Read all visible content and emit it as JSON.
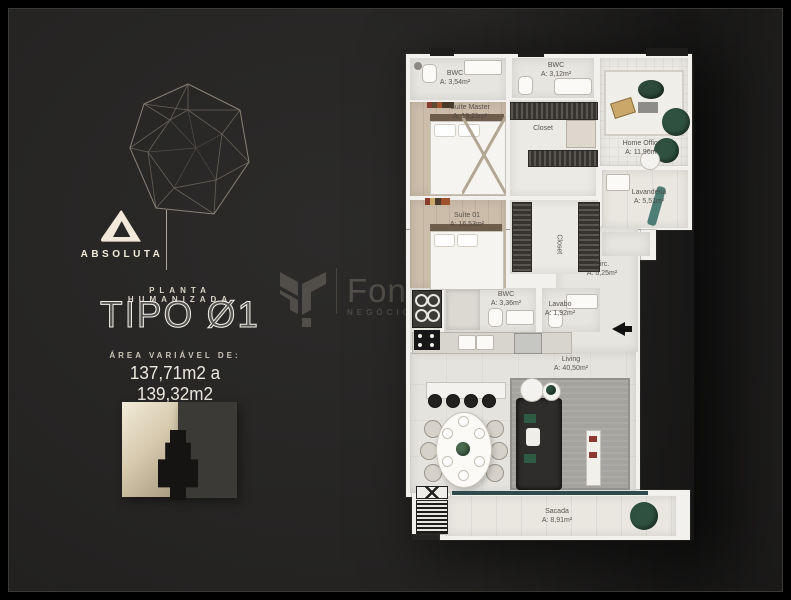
{
  "brand": {
    "logo_text": "ABSOLUTA"
  },
  "plan_header": {
    "kicker": "PLANTA HUMANIZADA",
    "title": "TIPO Ø1"
  },
  "area": {
    "label": "ÁREA VARIÁVEL DE:",
    "range": "137,71m2 a 139,32m2"
  },
  "watermark": {
    "name": "Fon",
    "tagline": "NEGÓCIOS"
  },
  "floorplan": {
    "rooms": [
      {
        "id": "bwc-master",
        "name": "BWC",
        "area": "A: 3,54m²"
      },
      {
        "id": "bwc-2",
        "name": "BWC",
        "area": "A: 3,12m²"
      },
      {
        "id": "suite-master",
        "name": "Suíte Master",
        "area": "A: 19,21m²"
      },
      {
        "id": "closet-master",
        "name": "Closet",
        "area": ""
      },
      {
        "id": "home-office",
        "name": "Home Office",
        "area": "A: 11,96m²"
      },
      {
        "id": "lavanderia",
        "name": "Lavanderia",
        "area": "A: 5,51m²"
      },
      {
        "id": "suite-01",
        "name": "Suíte 01",
        "area": "A: 16,53m²"
      },
      {
        "id": "closet-suite",
        "name": "Closet",
        "area": ""
      },
      {
        "id": "circ",
        "name": "Circ.",
        "area": "A: 5,25m²"
      },
      {
        "id": "bwc-social",
        "name": "BWC",
        "area": "A: 3,36m²"
      },
      {
        "id": "lavabo",
        "name": "Lavabo",
        "area": "A: 1,92m²"
      },
      {
        "id": "living",
        "name": "Living",
        "area": "A: 40,50m²"
      },
      {
        "id": "sacada",
        "name": "Sacada",
        "area": "A: 8,91m²"
      }
    ]
  },
  "colors": {
    "background": "#262524",
    "cream": "#f2ead9",
    "plan_wall": "#f3f1ed",
    "wood_floor": "#ccbcaa",
    "plant_green": "#2f5240",
    "teal_accent": "#3f6a64",
    "watermark_gray": "#53504b"
  }
}
